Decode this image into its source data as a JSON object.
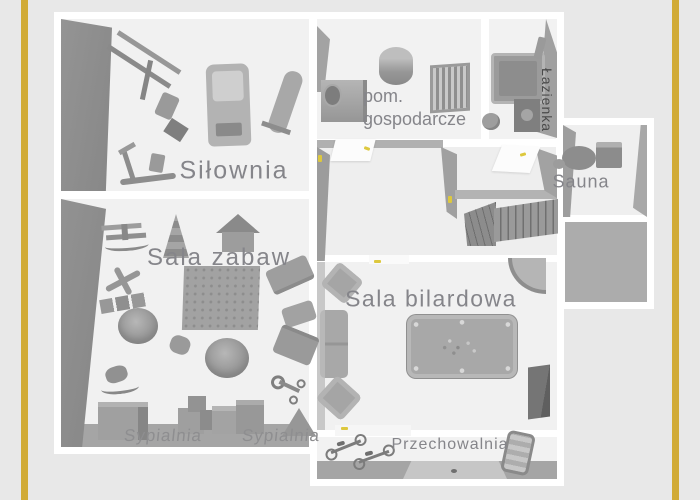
{
  "canvas": {
    "width": 700,
    "height": 500,
    "background": "#e8e8e8",
    "accent_stripe_color": "#d1ab36"
  },
  "palette": {
    "wall": "#ffffff",
    "floor": "#f1f1f1",
    "wall_shadow": "#969696",
    "cut_wall": "#a5a5a5",
    "terrace_floor": "#acacac",
    "furniture": "#9b9b9b",
    "label_text": "#85858a",
    "door_marker": "#ddc83e"
  },
  "rooms": {
    "gym": {
      "label": "Siłownia"
    },
    "utility": {
      "label_line1": "pom.",
      "label_line2": "gospodarcze"
    },
    "bathroom": {
      "label": "Łazienka"
    },
    "sauna": {
      "label": "Sauna"
    },
    "playroom": {
      "label": "Sala zabaw"
    },
    "billiard": {
      "label": "Sala bilardowa"
    },
    "bedroom_left": {
      "label": "Sypialnia"
    },
    "bedroom_right": {
      "label": "Sypialnia"
    },
    "storage": {
      "label": "Przechowalnia"
    }
  },
  "furniture": {
    "gym": [
      "multi-gym-machine",
      "treadmill",
      "weight-bench",
      "elliptical-trainer"
    ],
    "utility": [
      "water-heater-cylinder",
      "radiator",
      "washing-machine",
      "small-sink"
    ],
    "bathroom": [
      "shower-cabin",
      "washbasin-cabinet",
      "toilet",
      "shower-column"
    ],
    "sauna": [
      "round-table",
      "stool",
      "cabinet"
    ],
    "hallway": [
      "staircase",
      "open-door",
      "open-door"
    ],
    "playroom": [
      "rocking-biplane",
      "ring-stacking-tower",
      "play-house",
      "toy-plane",
      "toy-train",
      "bean-bag",
      "bean-bag",
      "play-rug",
      "sofa",
      "loveseat",
      "couch",
      "rocking-horse",
      "building-blocks",
      "toy-crates",
      "cabinet",
      "tricycle",
      "play-tent"
    ],
    "billiard": [
      "pool-table",
      "sofa",
      "armchair",
      "armchair",
      "corner-bar",
      "tall-dark-cabinet"
    ],
    "storage": [
      "bicycle",
      "bicycle",
      "sun-lounger"
    ]
  }
}
